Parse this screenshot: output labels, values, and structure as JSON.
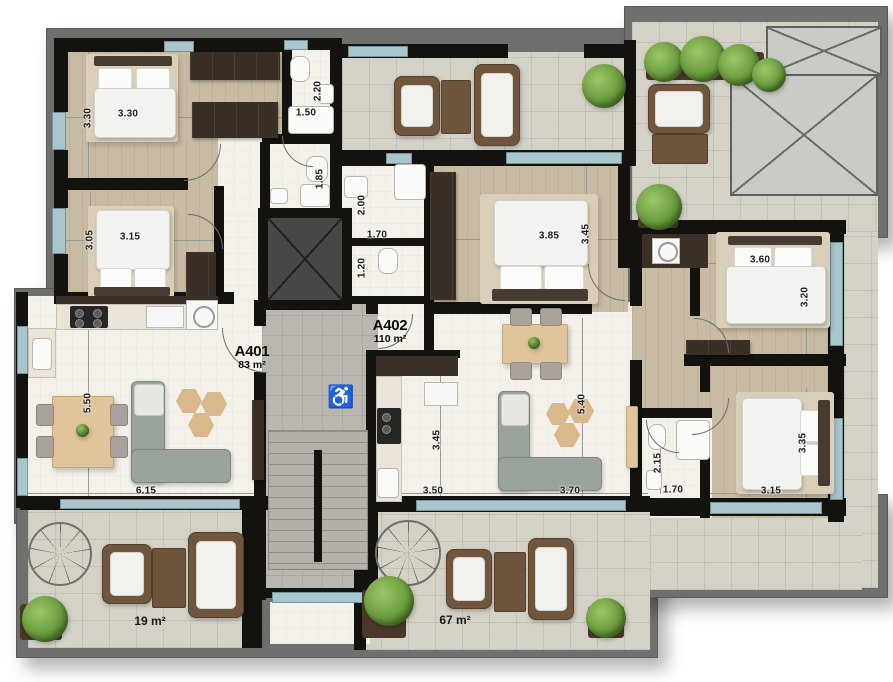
{
  "plan_title": "Floor plan",
  "apartments": [
    {
      "name": "A401",
      "area": "83 m²"
    },
    {
      "name": "A402",
      "area": "110 m²"
    }
  ],
  "terraces": [
    {
      "label": "19 m²"
    },
    {
      "label": "67 m²"
    }
  ],
  "dimensions": [
    {
      "t": "3.30"
    },
    {
      "t": "3.30"
    },
    {
      "t": "3.15"
    },
    {
      "t": "3.05"
    },
    {
      "t": "1.50"
    },
    {
      "t": "2.20"
    },
    {
      "t": "1.85"
    },
    {
      "t": "2.00"
    },
    {
      "t": "1.70"
    },
    {
      "t": "1.20"
    },
    {
      "t": "3.85"
    },
    {
      "t": "3.45"
    },
    {
      "t": "3.60"
    },
    {
      "t": "3.20"
    },
    {
      "t": "3.35"
    },
    {
      "t": "3.15"
    },
    {
      "t": "2.15"
    },
    {
      "t": "1.70"
    },
    {
      "t": "5.50"
    },
    {
      "t": "6.15"
    },
    {
      "t": "3.45"
    },
    {
      "t": "3.50"
    },
    {
      "t": "3.70"
    },
    {
      "t": "5.40"
    }
  ],
  "icons": {
    "accessible": "♿"
  },
  "colors": {
    "wall": "#14120f",
    "window_glass": "#a9c6cc",
    "wood_floor": "#c8bba3",
    "tile_floor": "#d4d1c7",
    "white_floor": "#f3f1ea",
    "stair_floor": "#b9b7af",
    "frame": "#6f6f6d",
    "plant": "#6a9b3d",
    "wardrobe": "#3a2f26"
  }
}
